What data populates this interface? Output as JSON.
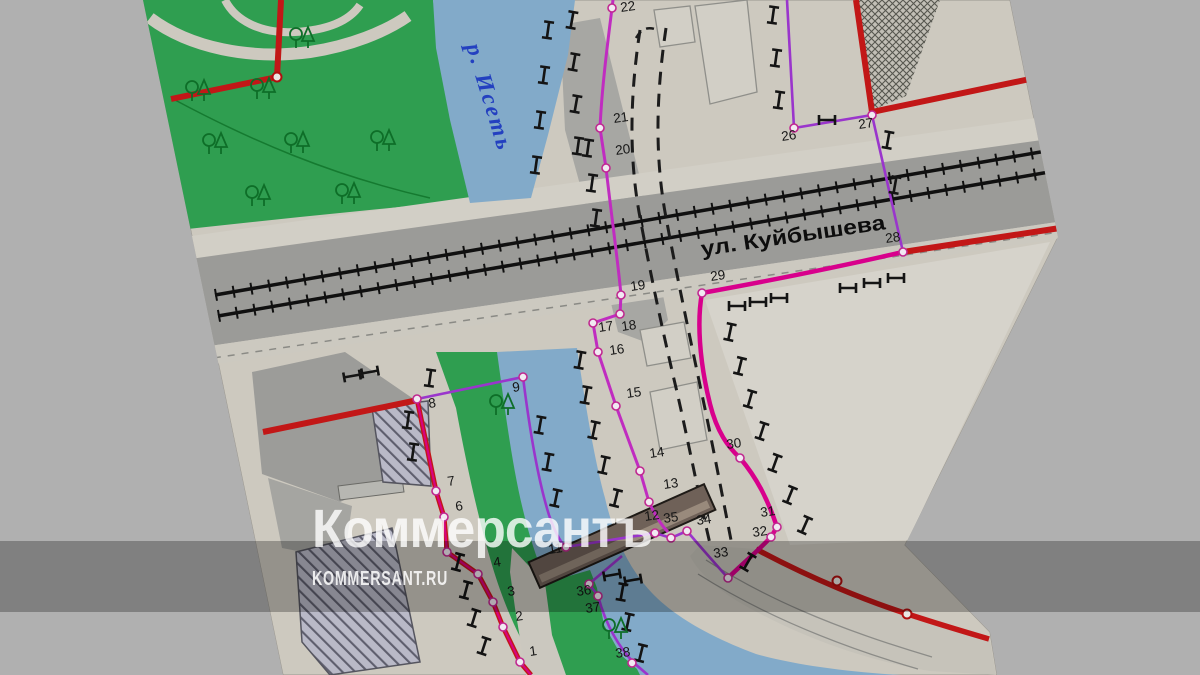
{
  "watermark": {
    "logo": "Коммерсантъ",
    "site": "KOMMERSANT.RU"
  },
  "map": {
    "street_label": "ул. Куйбышева",
    "river_label": "р. Исеть",
    "points": [
      {
        "label": "1"
      },
      {
        "label": "2"
      },
      {
        "label": "3"
      },
      {
        "label": "4"
      },
      {
        "label": "6"
      },
      {
        "label": "7"
      },
      {
        "label": "8"
      },
      {
        "label": "9"
      },
      {
        "label": "11"
      },
      {
        "label": "12"
      },
      {
        "label": "13"
      },
      {
        "label": "14"
      },
      {
        "label": "15"
      },
      {
        "label": "16"
      },
      {
        "label": "17"
      },
      {
        "label": "18"
      },
      {
        "label": "19"
      },
      {
        "label": "20"
      },
      {
        "label": "21"
      },
      {
        "label": "22"
      },
      {
        "label": "26"
      },
      {
        "label": "27"
      },
      {
        "label": "28"
      },
      {
        "label": "29"
      },
      {
        "label": "30"
      },
      {
        "label": "31"
      },
      {
        "label": "32"
      },
      {
        "label": "33"
      },
      {
        "label": "34"
      },
      {
        "label": "35"
      },
      {
        "label": "36"
      },
      {
        "label": "37"
      },
      {
        "label": "38"
      }
    ]
  },
  "colors": {
    "page_background": "#b0b0b0",
    "paper": "#cdc9bf",
    "park_green": "#2f9e50",
    "river_blue": "#82aac9",
    "asphalt": "#9b9b98",
    "boundary_red": "#c21717",
    "route_magenta": "#d8008c",
    "parcel_purple": "#9a35cc",
    "bank_line_magenta": "#c02cc0"
  }
}
